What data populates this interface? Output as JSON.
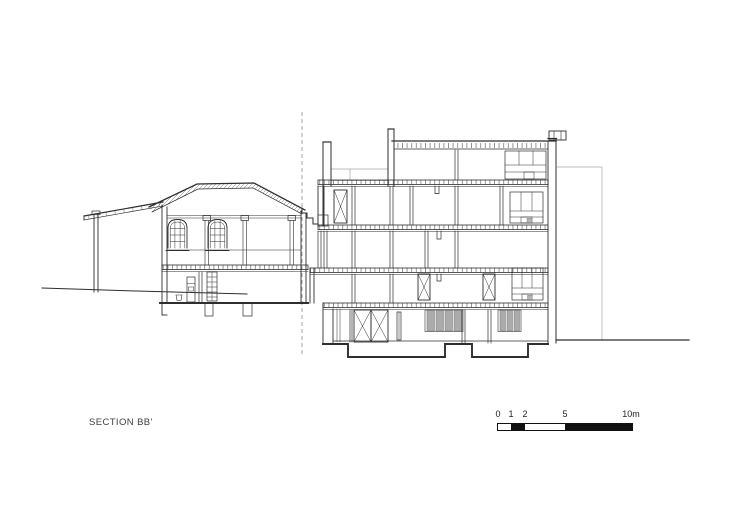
{
  "title": {
    "label": "SECTION BB'"
  },
  "scalebar": {
    "ticks": [
      {
        "value": 0,
        "label": "0"
      },
      {
        "value": 1,
        "label": "1"
      },
      {
        "value": 2,
        "label": "2"
      },
      {
        "value": 5,
        "label": "5"
      },
      {
        "value": 10,
        "label": "10m"
      }
    ],
    "segments": [
      {
        "from": 0,
        "to": 1,
        "fill": "white"
      },
      {
        "from": 1,
        "to": 2,
        "fill": "black"
      },
      {
        "from": 2,
        "to": 5,
        "fill": "white"
      },
      {
        "from": 5,
        "to": 10,
        "fill": "black"
      }
    ]
  },
  "colors": {
    "line": "#2e2e2e",
    "light": "#bcbcbc",
    "winfill": "#ababab",
    "text": "#404040",
    "bg": "#ffffff",
    "scaleblack": "#111111"
  }
}
